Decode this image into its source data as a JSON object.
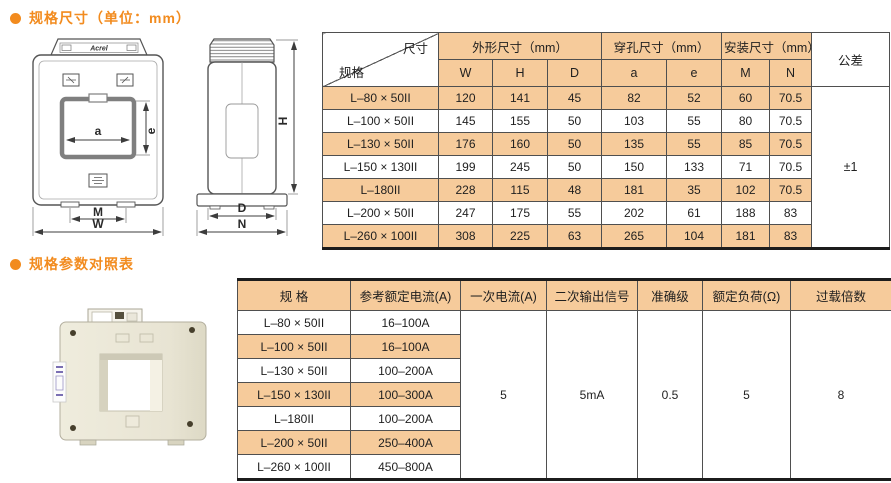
{
  "titles": {
    "dimensions": "规格尺寸（单位：mm）",
    "parameters": "规格参数对照表"
  },
  "dim_table": {
    "corner": {
      "dim": "尺寸",
      "spec": "规格"
    },
    "group_headers": [
      "外形尺寸（mm）",
      "穿孔尺寸（mm）",
      "安装尺寸（mm）"
    ],
    "sub_headers": [
      "W",
      "H",
      "D",
      "a",
      "e",
      "M",
      "N"
    ],
    "tolerance_header": "公差",
    "tolerance_value": "±1",
    "rows": [
      {
        "spec": "L–80 × 50II",
        "w": "120",
        "h": "141",
        "d": "45",
        "a": "82",
        "e": "52",
        "m": "60",
        "n": "70.5"
      },
      {
        "spec": "L–100 × 50II",
        "w": "145",
        "h": "155",
        "d": "50",
        "a": "103",
        "e": "55",
        "m": "80",
        "n": "70.5"
      },
      {
        "spec": "L–130 × 50II",
        "w": "176",
        "h": "160",
        "d": "50",
        "a": "135",
        "e": "55",
        "m": "85",
        "n": "70.5"
      },
      {
        "spec": "L–150 × 130II",
        "w": "199",
        "h": "245",
        "d": "50",
        "a": "150",
        "e": "133",
        "m": "71",
        "n": "70.5"
      },
      {
        "spec": "L–180II",
        "w": "228",
        "h": "115",
        "d": "48",
        "a": "181",
        "e": "35",
        "m": "102",
        "n": "70.5"
      },
      {
        "spec": "L–200 × 50II",
        "w": "247",
        "h": "175",
        "d": "55",
        "a": "202",
        "e": "61",
        "m": "188",
        "n": "83"
      },
      {
        "spec": "L–260 × 100II",
        "w": "308",
        "h": "225",
        "d": "63",
        "a": "265",
        "e": "104",
        "m": "181",
        "n": "83"
      }
    ]
  },
  "param_table": {
    "headers": [
      "规 格",
      "参考额定电流(A)",
      "一次电流(A)",
      "二次输出信号",
      "准确级",
      "额定负荷(Ω)",
      "过载倍数"
    ],
    "rows": [
      {
        "spec": "L–80 × 50II",
        "current": "16–100A"
      },
      {
        "spec": "L–100 × 50II",
        "current": "16–100A"
      },
      {
        "spec": "L–130 × 50II",
        "current": "100–200A"
      },
      {
        "spec": "L–150 × 130II",
        "current": "100–300A"
      },
      {
        "spec": "L–180II",
        "current": "100–200A"
      },
      {
        "spec": "L–200 × 50II",
        "current": "250–400A"
      },
      {
        "spec": "L–260 × 100II",
        "current": "450–800A"
      }
    ],
    "merged": {
      "primary_current": "5",
      "secondary_output": "5mA",
      "accuracy_class": "0.5",
      "rated_load": "5",
      "overload_multiple": "8"
    }
  },
  "drawings": {
    "brand": "Acrel",
    "front": {
      "a": "a",
      "e": "e",
      "m": "M",
      "w": "W"
    },
    "side": {
      "h": "H",
      "d": "D",
      "n": "N"
    }
  },
  "colors": {
    "accent_orange": "#F28B1E",
    "row_peach": "#F6CB9B",
    "border_dark": "#1c1c1c"
  }
}
